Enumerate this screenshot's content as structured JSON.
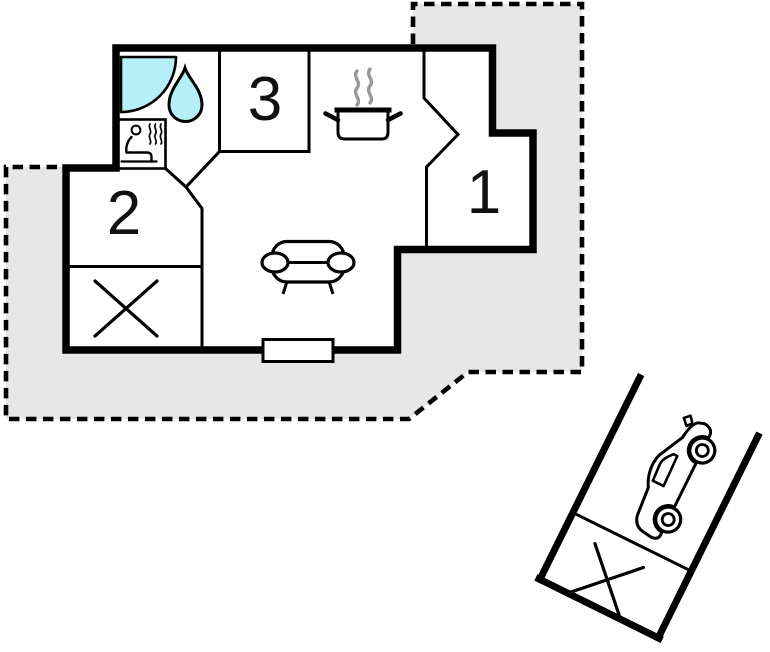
{
  "plan": {
    "type": "holiday-home-floorplan",
    "rooms": [
      {
        "label": "1"
      },
      {
        "label": "2"
      },
      {
        "label": "3"
      }
    ],
    "icons": [
      "shower-icon",
      "water-drop-icon",
      "sauna-icon",
      "cooking-pot-icon",
      "steam-icon",
      "sofa-icon",
      "storage-cross-icon",
      "terrace-door",
      "car-icon",
      "carport-storage-cross-icon"
    ]
  },
  "colors": {
    "plot_fill": "#e7e7e7",
    "line_black": "#000000",
    "water_fill": "#b5eff7",
    "steam_gray": "#999999"
  }
}
